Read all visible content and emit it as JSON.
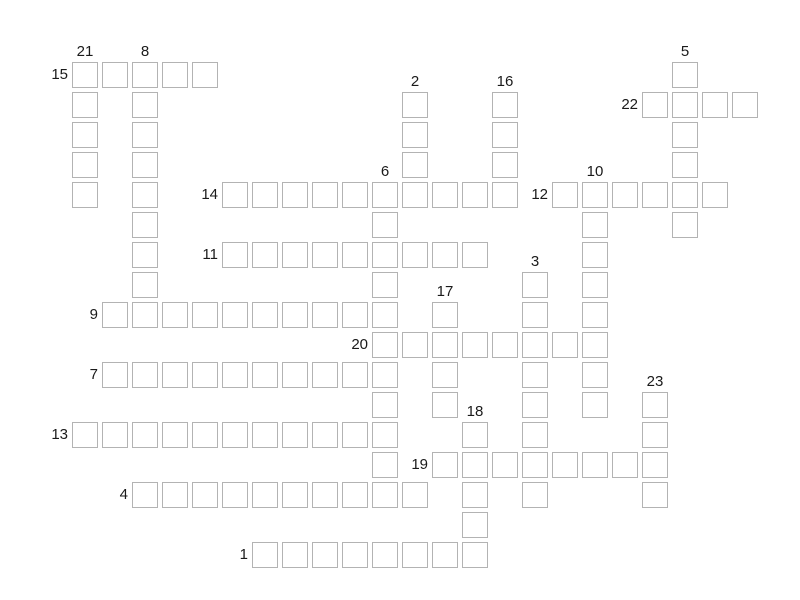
{
  "puzzle": {
    "type": "crossword",
    "background_color": "#ffffff",
    "cell_fill_color": "#ffffff",
    "cell_border_color": "#b3b3b3",
    "label_color": "#1a1a1a",
    "grid": {
      "origin_x": 72,
      "origin_y": 62,
      "cell_size": 26,
      "cell_pitch": 30
    },
    "entries": [
      {
        "number": 1,
        "direction": "across",
        "col": 6,
        "row": 16,
        "length": 8
      },
      {
        "number": 2,
        "direction": "down",
        "col": 11,
        "row": 1,
        "length": 4
      },
      {
        "number": 3,
        "direction": "down",
        "col": 15,
        "row": 7,
        "length": 8
      },
      {
        "number": 4,
        "direction": "across",
        "col": 2,
        "row": 14,
        "length": 10
      },
      {
        "number": 5,
        "direction": "down",
        "col": 20,
        "row": 0,
        "length": 6
      },
      {
        "number": 6,
        "direction": "down",
        "col": 10,
        "row": 4,
        "length": 11
      },
      {
        "number": 7,
        "direction": "across",
        "col": 1,
        "row": 10,
        "length": 10
      },
      {
        "number": 8,
        "direction": "down",
        "col": 2,
        "row": 0,
        "length": 9
      },
      {
        "number": 9,
        "direction": "across",
        "col": 1,
        "row": 8,
        "length": 10
      },
      {
        "number": 10,
        "direction": "down",
        "col": 17,
        "row": 4,
        "length": 8
      },
      {
        "number": 11,
        "direction": "across",
        "col": 5,
        "row": 6,
        "length": 9
      },
      {
        "number": 12,
        "direction": "across",
        "col": 16,
        "row": 4,
        "length": 6
      },
      {
        "number": 13,
        "direction": "across",
        "col": 0,
        "row": 12,
        "length": 11
      },
      {
        "number": 14,
        "direction": "across",
        "col": 5,
        "row": 4,
        "length": 10
      },
      {
        "number": 15,
        "direction": "across",
        "col": 0,
        "row": 0,
        "length": 5
      },
      {
        "number": 16,
        "direction": "down",
        "col": 14,
        "row": 1,
        "length": 4
      },
      {
        "number": 17,
        "direction": "down",
        "col": 12,
        "row": 8,
        "length": 4
      },
      {
        "number": 18,
        "direction": "down",
        "col": 13,
        "row": 12,
        "length": 5
      },
      {
        "number": 19,
        "direction": "across",
        "col": 12,
        "row": 13,
        "length": 8
      },
      {
        "number": 20,
        "direction": "across",
        "col": 10,
        "row": 9,
        "length": 8
      },
      {
        "number": 21,
        "direction": "down",
        "col": 0,
        "row": 0,
        "length": 5
      },
      {
        "number": 22,
        "direction": "across",
        "col": 19,
        "row": 1,
        "length": 4
      },
      {
        "number": 23,
        "direction": "down",
        "col": 19,
        "row": 11,
        "length": 4
      }
    ]
  }
}
